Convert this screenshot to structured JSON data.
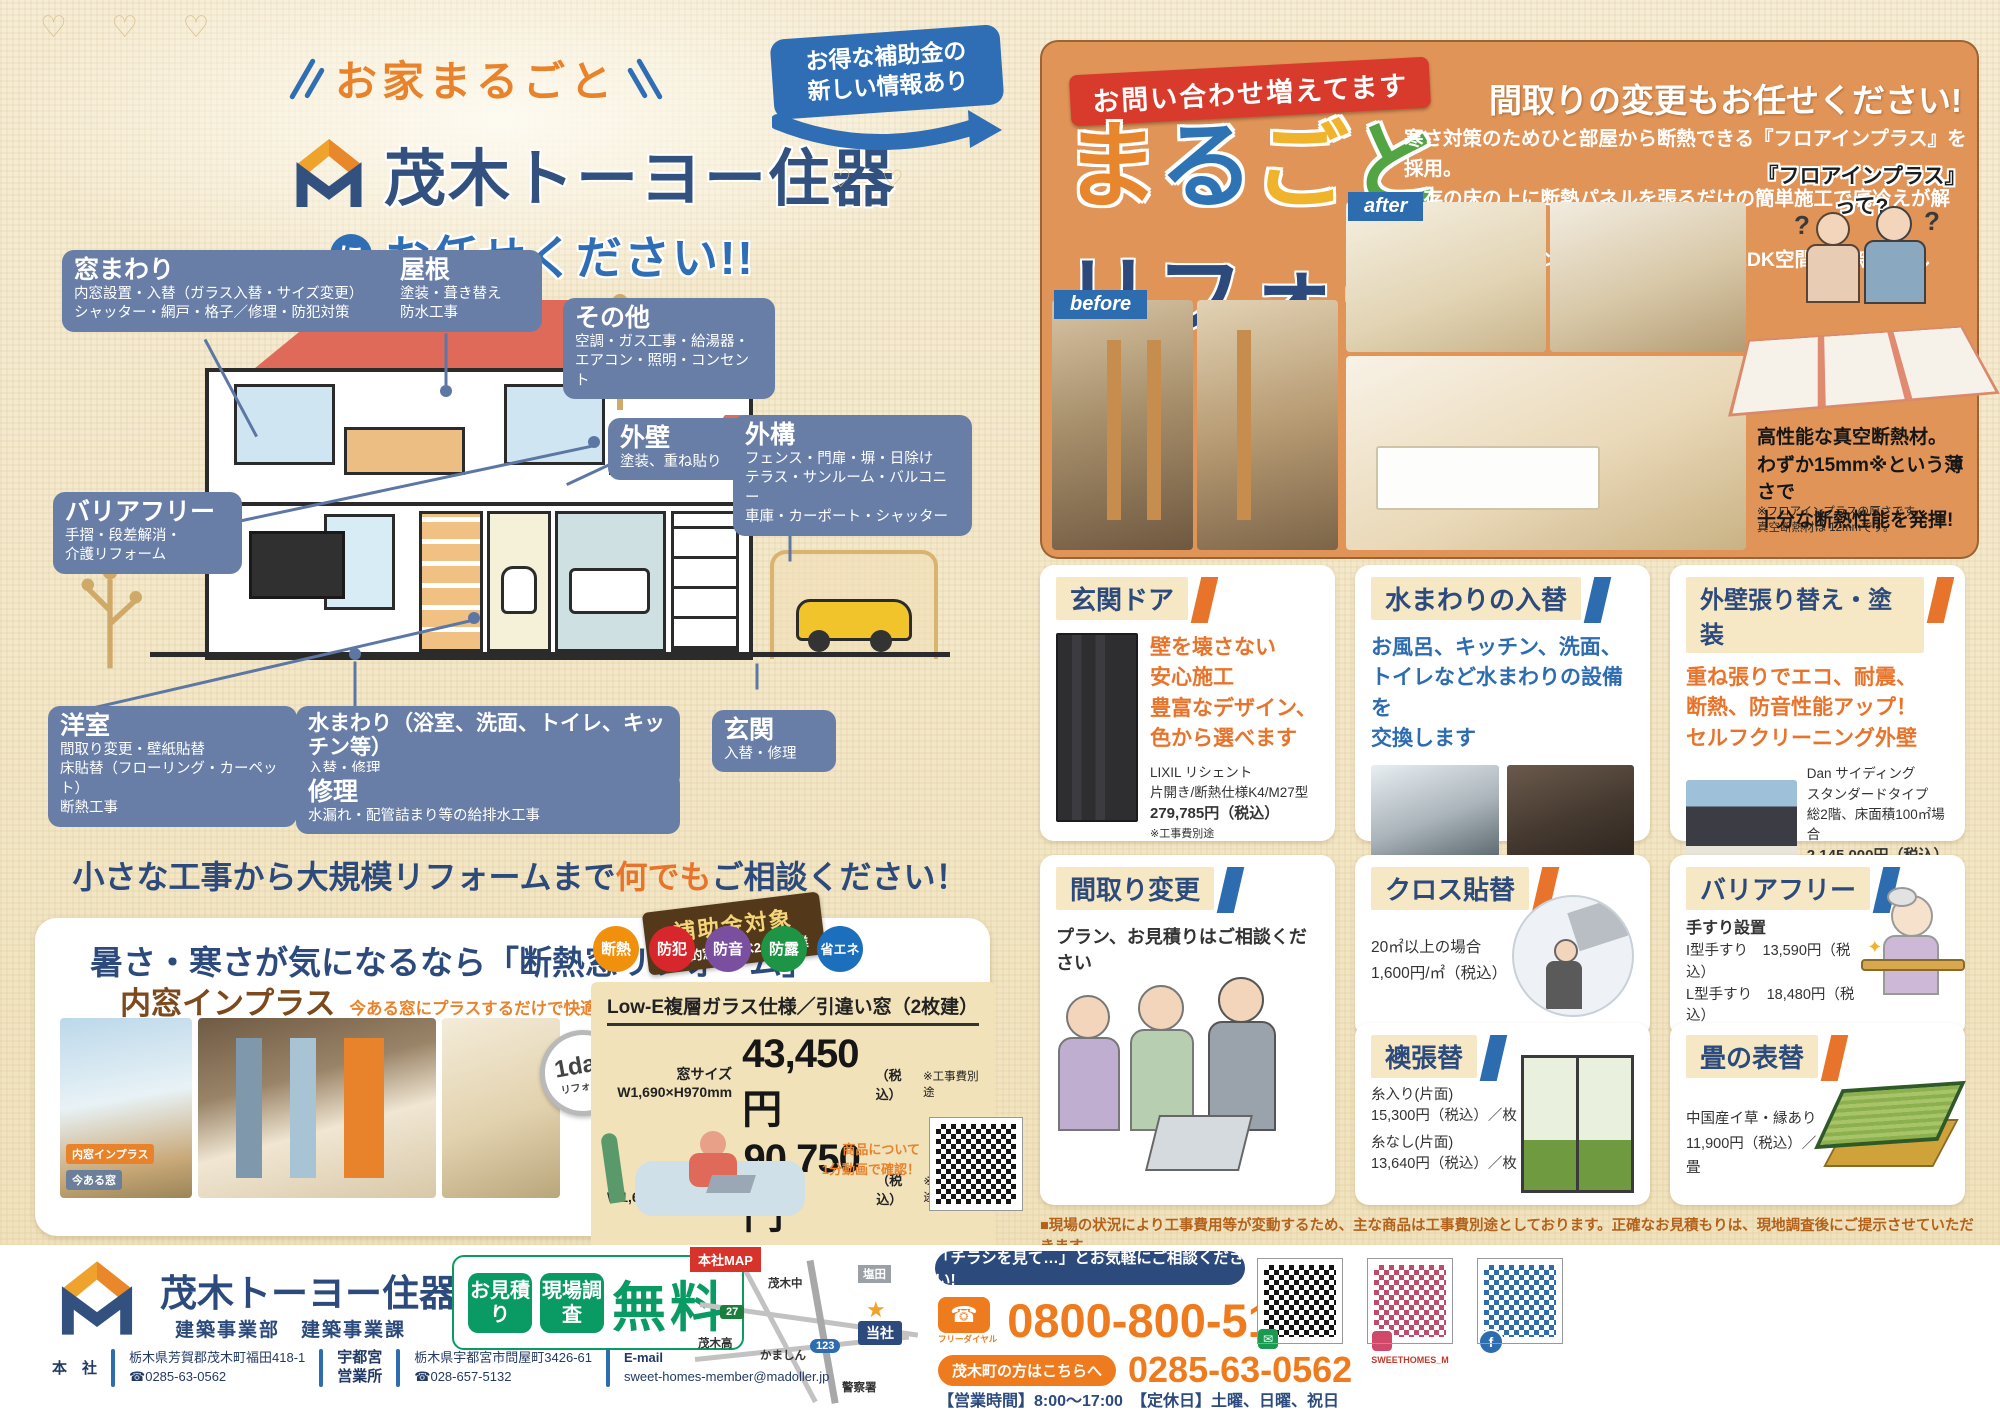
{
  "header": {
    "top_badge": "お家まるごと",
    "company": "茂木トーヨー住器",
    "ni": "に",
    "request": "お任せください!!",
    "subsidy_line1": "お得な補助金の",
    "subsidy_line2": "新しい情報あり"
  },
  "house": {
    "labels": [
      {
        "title": "窓まわり",
        "lines": [
          "内窓設置・入替（ガラス入替・サイズ変更）",
          "シャッター・網戸・格子／修理・防犯対策"
        ]
      },
      {
        "title": "屋根",
        "lines": [
          "塗装・葺き替え",
          "防水工事"
        ]
      },
      {
        "title": "その他",
        "lines": [
          "空調・ガス工事・給湯器・",
          "エアコン・照明・コンセント"
        ]
      },
      {
        "title": "外壁",
        "lines": [
          "塗装、重ね貼り"
        ]
      },
      {
        "title": "外構",
        "lines": [
          "フェンス・門扉・塀・日除け",
          "テラス・サンルーム・バルコニー",
          "車庫・カーポート・シャッター"
        ]
      },
      {
        "title": "バリアフリー",
        "lines": [
          "手摺・段差解消・",
          "介護リフォーム"
        ]
      },
      {
        "title": "洋室",
        "lines": [
          "間取り変更・壁紙貼替",
          "床貼替（フローリング・カーペット）",
          "断熱工事"
        ]
      },
      {
        "title": "水まわり（浴室、洗面、トイレ、キッチン等）",
        "lines": [
          "入替・修理"
        ]
      },
      {
        "title": "修理",
        "lines": [
          "水漏れ・配管詰まり等の給排水工事"
        ]
      },
      {
        "title": "玄関",
        "lines": [
          "入替・修理"
        ]
      }
    ]
  },
  "tagline": {
    "pre": "小さな工事から大規模リフォームまで",
    "em": "何でも",
    "post": "ご相談ください！"
  },
  "insulation": {
    "title": "暑さ・寒さが気になるなら「断熱窓リフォーム」",
    "ribbon_line1": "補助金対象",
    "ribbon_line2": "先進的窓リノベ2025事業",
    "product": "内窓インプラス",
    "product_sub": "今ある窓にプラスするだけで快適空間",
    "day_badge_1": "1day",
    "day_badge_2": "リフォーム",
    "photo_label_new": "内窓インプラス",
    "photo_label_old": "今ある窓",
    "features": [
      "断熱",
      "防犯",
      "防音",
      "防露",
      "省エネ"
    ],
    "spec_title": "Low-E複層ガラス仕様／引違い窓（2枚建）",
    "rows": [
      {
        "size_label": "窓サイズ",
        "size": "W1,690×H970mm",
        "price": "43,450円",
        "tax": "（税込）",
        "note": "※工事費別途"
      },
      {
        "size_label": "テラスサイズ",
        "size": "W1,690×H1,830mm",
        "price": "90,750円",
        "tax": "（税込）",
        "note": "※工事費別途"
      }
    ],
    "video_note_1": "商品について",
    "video_note_2": "1分動画で確認！"
  },
  "marugoto": {
    "ribbon": "お問い合わせ増えてます",
    "chars": [
      "ま",
      "る",
      "ご",
      "と"
    ],
    "title2": "リフォーム",
    "headline": "間取りの変更もお任せください!",
    "body": [
      "寒さ対策のためひと部屋から断熱できる『フロアインプラス』を採用。",
      "既存の床の上に断熱パネルを張るだけの簡単施工で底冷えが解消◎",
      "合わせてキッチンの入替もして快適なLDK空間に一新しました。"
    ],
    "before": "before",
    "after": "after",
    "floor_q": "『フロアインプラス』って?",
    "floor_desc": [
      "高性能な真空断熱材。",
      "わずか15mm※という薄さで",
      "十分な断熱性能を発揮!"
    ],
    "floor_note": [
      "※フロアインプラスの厚さです。",
      "真空断熱材は 12mmです。"
    ]
  },
  "cards": [
    {
      "title": "玄関ドア",
      "lead": [
        "壁を壊さない",
        "安心施工",
        "豊富なデザイン、",
        "色から選べます"
      ],
      "details": [
        "LIXIL リシェント",
        "片開き/断熱仕様K4/M27型",
        "279,785円（税込）",
        "※工事費別途"
      ]
    },
    {
      "title": "水まわりの入替",
      "lead": [
        "お風呂、キッチン、洗面、",
        "トイレなど水まわりの設備を",
        "交換します"
      ]
    },
    {
      "title": "外壁張り替え・塗装",
      "lead": [
        "重ね張りでエコ、耐震、",
        "断熱、防音性能アップ！",
        "セルフクリーニング外壁"
      ],
      "details": [
        "Dan サイディング",
        "スタンダードタイプ",
        "総2階、床面積100㎡場合",
        "2,145,000円（税込）"
      ]
    },
    {
      "title": "間取り変更",
      "lead": [
        "プラン、お見積りはご相談ください"
      ]
    },
    {
      "title": "クロス貼替",
      "lines": [
        "20㎡以上の場合",
        "1,600円/㎡（税込）"
      ]
    },
    {
      "title": "バリアフリー",
      "lines": [
        "手すり設置",
        "I型手すり　13,590円（税込）",
        "L型手すり　18,480円（税込）",
        "※標準取付費含む"
      ]
    },
    {
      "title": "襖張替",
      "lines": [
        "糸入り(片面)",
        "15,300円（税込）／枚",
        "糸なし(片面)",
        "13,640円（税込）／枚"
      ]
    },
    {
      "title": "畳の表替",
      "lines": [
        "中国産イ草・縁あり",
        "11,900円（税込）／畳"
      ]
    }
  ],
  "footnote": "■現場の状況により工事費用等が変動するため、主な商品は工事費別途としております。正確なお見積もりは、現地調査後にご提示させていただきます。",
  "footer": {
    "company": "茂木トーヨー住器",
    "company_suffix1": "株式",
    "company_suffix2": "会社",
    "dept": "建築事業部　建築事業課",
    "badge1": "お見積り",
    "badge2": "現場調査",
    "free": "無料",
    "map_title": "本社MAP",
    "map_labels": [
      "茂木中",
      "塩田",
      "茂木高",
      "かましん",
      "警察署"
    ],
    "map_here": "当社",
    "route1": "27",
    "route2": "123",
    "contact_bar": "「チラシを見て…」とお気軽にご相談ください!",
    "freedial": "フリーダイヤル",
    "phone1": "0800-800-5134",
    "local_label": "茂木町の方はこちらへ",
    "phone2": "0285-63-0562",
    "hours": "【営業時間】8:00〜17:00　【定休日】土曜、日曜、祝日",
    "qr2_label": "SWEETHOMES_M",
    "hq_label": "本　社",
    "hq_addr": "栃木県芳賀郡茂木町福田418-1",
    "hq_tel": "☎0285-63-0562",
    "br_label1": "宇都宮",
    "br_label2": "営業所",
    "br_addr": "栃木県宇都宮市問屋町3426-61",
    "br_tel": "☎028-657-5132",
    "email_label": "E-mail",
    "email": "sweet-homes-member@madoller.jp"
  }
}
